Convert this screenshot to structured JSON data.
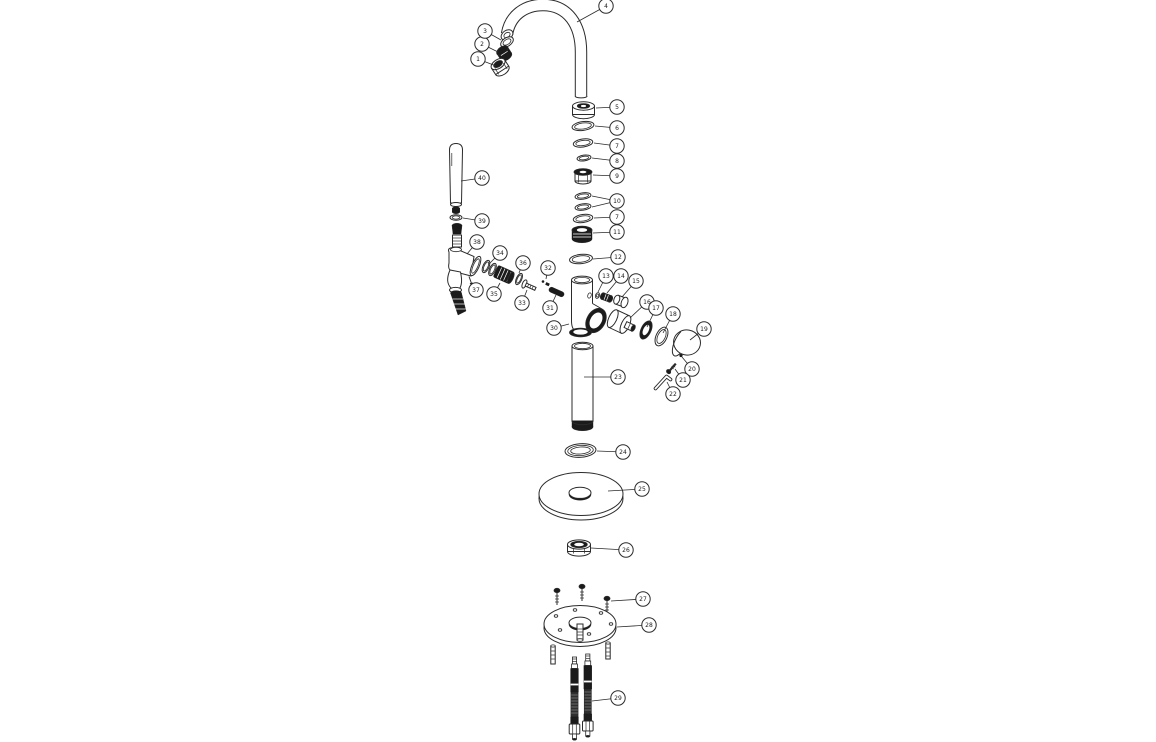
{
  "page": {
    "background": "#ffffff",
    "kind": "exploded-parts-diagram",
    "subject": "tap-mixer-assembly"
  },
  "diagram": {
    "line_color": "#2b2b2b",
    "dark_fill": "#1b1b1b",
    "callout_style": {
      "radius": 7.2,
      "font_size": 6,
      "text_dy": 2.1
    },
    "callouts": [
      {
        "id": "c1",
        "label": "1",
        "cx": 478,
        "cy": 59,
        "targets": [
          [
            496,
            66
          ]
        ]
      },
      {
        "id": "c2",
        "label": "2",
        "cx": 482,
        "cy": 44,
        "targets": [
          [
            498,
            52
          ]
        ]
      },
      {
        "id": "c3",
        "label": "3",
        "cx": 485,
        "cy": 31,
        "targets": [
          [
            501,
            40
          ]
        ]
      },
      {
        "id": "c4",
        "label": "4",
        "cx": 606,
        "cy": 6,
        "targets": [
          [
            577,
            22
          ]
        ]
      },
      {
        "id": "c5",
        "label": "5",
        "cx": 617,
        "cy": 107,
        "targets": [
          [
            596,
            108
          ]
        ]
      },
      {
        "id": "c6",
        "label": "6",
        "cx": 617,
        "cy": 128,
        "targets": [
          [
            595,
            126
          ]
        ]
      },
      {
        "id": "c7a",
        "label": "7",
        "cx": 617,
        "cy": 146,
        "targets": [
          [
            594,
            143
          ]
        ]
      },
      {
        "id": "c8",
        "label": "8",
        "cx": 617,
        "cy": 161,
        "targets": [
          [
            592,
            158
          ]
        ]
      },
      {
        "id": "c9",
        "label": "9",
        "cx": 617,
        "cy": 176,
        "targets": [
          [
            593,
            175
          ]
        ]
      },
      {
        "id": "c10",
        "label": "10",
        "cx": 617,
        "cy": 201,
        "targets": [
          [
            592,
            196
          ],
          [
            592,
            207
          ]
        ]
      },
      {
        "id": "c7b",
        "label": "7",
        "cx": 617,
        "cy": 217,
        "targets": [
          [
            594,
            218
          ]
        ]
      },
      {
        "id": "c11",
        "label": "11",
        "cx": 617,
        "cy": 232,
        "targets": [
          [
            593,
            233
          ]
        ]
      },
      {
        "id": "c12",
        "label": "12",
        "cx": 618,
        "cy": 257,
        "targets": [
          [
            593,
            259
          ]
        ]
      },
      {
        "id": "c13",
        "label": "13",
        "cx": 606,
        "cy": 276,
        "targets": [
          [
            598,
            292
          ]
        ]
      },
      {
        "id": "c14",
        "label": "14",
        "cx": 621,
        "cy": 276,
        "targets": [
          [
            607,
            293
          ]
        ]
      },
      {
        "id": "c15",
        "label": "15",
        "cx": 636,
        "cy": 281,
        "targets": [
          [
            622,
            297
          ]
        ]
      },
      {
        "id": "c16",
        "label": "16",
        "cx": 647,
        "cy": 302,
        "targets": [
          [
            630,
            318
          ]
        ]
      },
      {
        "id": "c17",
        "label": "17",
        "cx": 656,
        "cy": 308,
        "targets": [
          [
            647,
            327
          ]
        ]
      },
      {
        "id": "c18",
        "label": "18",
        "cx": 673,
        "cy": 314,
        "targets": [
          [
            663,
            333
          ]
        ]
      },
      {
        "id": "c19",
        "label": "19",
        "cx": 704,
        "cy": 329,
        "targets": [
          [
            690,
            340
          ]
        ]
      },
      {
        "id": "c20",
        "label": "20",
        "cx": 692,
        "cy": 369,
        "targets": [
          [
            682,
            357
          ]
        ]
      },
      {
        "id": "c21",
        "label": "21",
        "cx": 683,
        "cy": 380,
        "targets": [
          [
            675,
            369
          ]
        ]
      },
      {
        "id": "c22",
        "label": "22",
        "cx": 673,
        "cy": 394,
        "targets": [
          [
            667,
            382
          ]
        ]
      },
      {
        "id": "c23",
        "label": "23",
        "cx": 618,
        "cy": 377,
        "targets": [
          [
            584,
            377
          ]
        ]
      },
      {
        "id": "c24",
        "label": "24",
        "cx": 623,
        "cy": 452,
        "targets": [
          [
            597,
            451
          ]
        ]
      },
      {
        "id": "c25",
        "label": "25",
        "cx": 642,
        "cy": 489,
        "targets": [
          [
            608,
            491
          ]
        ]
      },
      {
        "id": "c26",
        "label": "26",
        "cx": 626,
        "cy": 550,
        "targets": [
          [
            591,
            548
          ]
        ]
      },
      {
        "id": "c27",
        "label": "27",
        "cx": 643,
        "cy": 599,
        "targets": [
          [
            611,
            601
          ]
        ]
      },
      {
        "id": "c28",
        "label": "28",
        "cx": 649,
        "cy": 625,
        "targets": [
          [
            617,
            627
          ]
        ]
      },
      {
        "id": "c29",
        "label": "29",
        "cx": 618,
        "cy": 698,
        "targets": [
          [
            592,
            701
          ]
        ]
      },
      {
        "id": "c30",
        "label": "30",
        "cx": 554,
        "cy": 328,
        "targets": [
          [
            569,
            324
          ]
        ]
      },
      {
        "id": "c31",
        "label": "31",
        "cx": 550,
        "cy": 308,
        "targets": [
          [
            556,
            295
          ]
        ]
      },
      {
        "id": "c32",
        "label": "32",
        "cx": 548,
        "cy": 268,
        "targets": [
          [
            546,
            279
          ]
        ]
      },
      {
        "id": "c33",
        "label": "33",
        "cx": 522,
        "cy": 303,
        "targets": [
          [
            527,
            290
          ]
        ]
      },
      {
        "id": "c34",
        "label": "34",
        "cx": 500,
        "cy": 253,
        "targets": [
          [
            489,
            264
          ]
        ]
      },
      {
        "id": "c35",
        "label": "35",
        "cx": 494,
        "cy": 294,
        "targets": [
          [
            500,
            283
          ]
        ]
      },
      {
        "id": "c36",
        "label": "36",
        "cx": 523,
        "cy": 263,
        "targets": [
          [
            519,
            273
          ]
        ]
      },
      {
        "id": "c37",
        "label": "37",
        "cx": 476,
        "cy": 290,
        "targets": [
          [
            470,
            283
          ]
        ]
      },
      {
        "id": "c38",
        "label": "38",
        "cx": 477,
        "cy": 242,
        "targets": [
          [
            467,
            254
          ]
        ]
      },
      {
        "id": "c39",
        "label": "39",
        "cx": 482,
        "cy": 221,
        "targets": [
          [
            463,
            218
          ]
        ]
      },
      {
        "id": "c40",
        "label": "40",
        "cx": 482,
        "cy": 178,
        "targets": [
          [
            461,
            181
          ]
        ]
      }
    ]
  }
}
